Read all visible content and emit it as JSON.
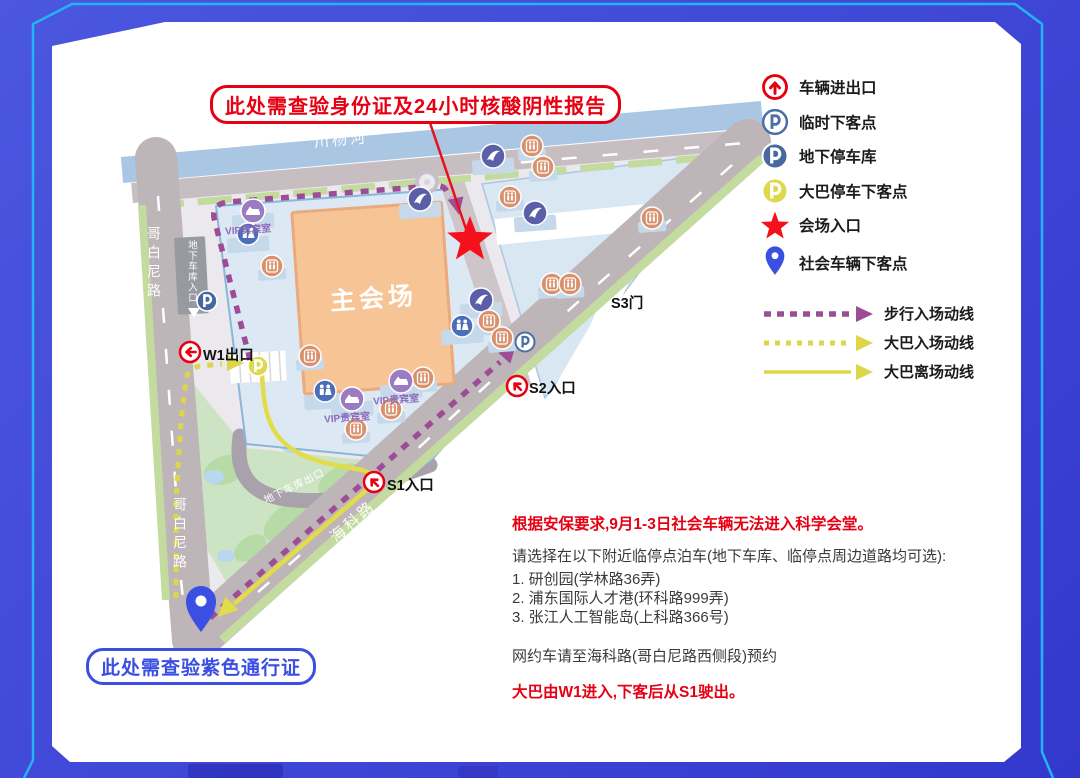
{
  "callouts": {
    "top": "此处需查验身份证及24小时核酸阴性报告",
    "bottom": "此处需查验紫色通行证"
  },
  "legend": {
    "items": [
      {
        "icon": "vehicle-gate-icon",
        "label": "车辆进出口"
      },
      {
        "icon": "temp-dropoff-icon",
        "label": "临时下客点"
      },
      {
        "icon": "underground-parking-icon",
        "label": "地下停车库"
      },
      {
        "icon": "bus-dropoff-icon",
        "label": "大巴停车下客点"
      },
      {
        "icon": "venue-entrance-icon",
        "label": "会场入口"
      },
      {
        "icon": "social-vehicle-dropoff-icon",
        "label": "社会车辆下客点"
      }
    ],
    "routes": [
      {
        "style": "dashed",
        "color": "#9c4d96",
        "label": "步行入场动线"
      },
      {
        "style": "dotted",
        "color": "#ddd64b",
        "label": "大巴入场动线"
      },
      {
        "style": "solid",
        "color": "#ddd64b",
        "label": "大巴离场动线"
      }
    ]
  },
  "map": {
    "river": "川杨河",
    "west_road": "哥白尼路",
    "south_road": "海科路",
    "main_hall": "主会场",
    "gates": {
      "w1": "W1出口",
      "s1": "S1入口",
      "s2": "S2入口",
      "s3": "S3门"
    },
    "garage_entrance": "地下车库入口",
    "garage_exit": "地下车库出口",
    "vip": "VIP贵宾室"
  },
  "notes": {
    "security": "根据安保要求,9月1-3日社会车辆无法进入科学会堂。",
    "parking_intro": "请选择在以下附近临停点泊车(地下车库、临停点周边道路均可选):",
    "parking_options": [
      "1. 研创园(学林路36弄)",
      "2. 浦东国际人才港(环科路999弄)",
      "3. 张江人工智能岛(上科路366号)"
    ],
    "taxi": "网约车请至海科路(哥白尼路西侧段)预约",
    "bus": "大巴由W1进入,下客后从S1驶出。"
  },
  "colors": {
    "accent_red": "#e60012",
    "accent_blue": "#3b4fe2",
    "walk_route": "#9c4d96",
    "bus_route": "#ddd64b",
    "background": "#4450d8",
    "panel_border_line": "#25b4f3"
  }
}
